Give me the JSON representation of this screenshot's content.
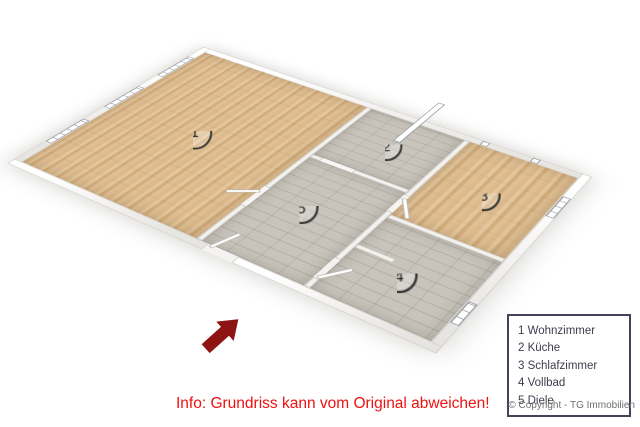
{
  "floorplan": {
    "rooms": [
      {
        "number": "1",
        "name": "Wohnzimmer"
      },
      {
        "number": "2",
        "name": "Küche"
      },
      {
        "number": "3",
        "name": "Schlafzimmer"
      },
      {
        "number": "4",
        "name": "Vollbad"
      },
      {
        "number": "5",
        "name": "Diele"
      }
    ]
  },
  "legend": {
    "items": [
      "1 Wohnzimmer",
      "2 Küche",
      "3 Schlafzimmer",
      "4 Vollbad",
      "5 Diele"
    ]
  },
  "info_text": "Info: Grundriss kann vom Original abweichen!",
  "copyright": "© Copyright - TG Immobilien",
  "colors": {
    "info_text": "#ee1111",
    "arrow": "#8e1414",
    "legend_border": "#42425c",
    "legend_text": "#3d3d4f",
    "wood_floor": "#dcb88c",
    "tile_floor": "#c8c4bb",
    "wall_face": "#d2d0cc"
  }
}
